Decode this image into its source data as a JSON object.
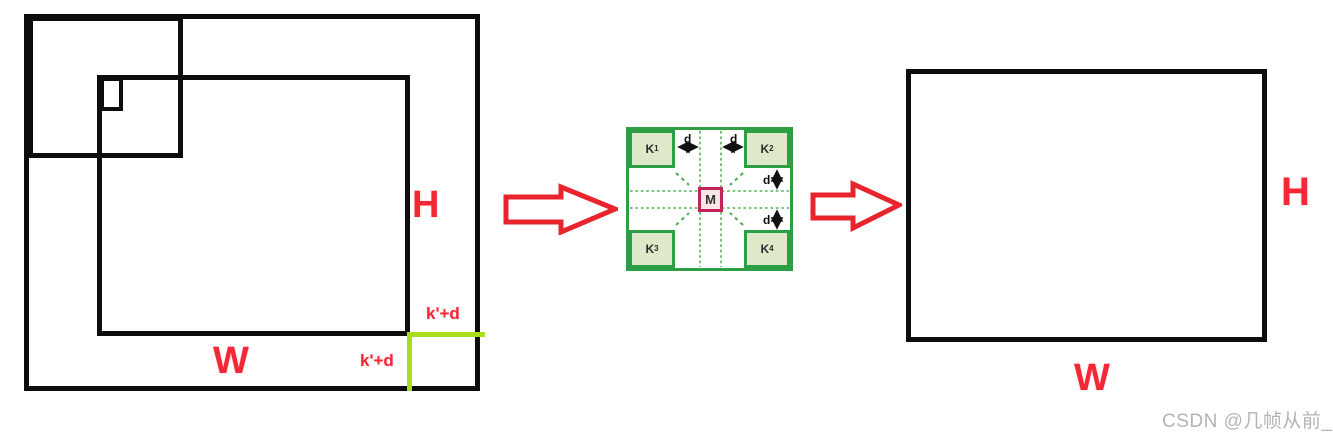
{
  "left_figure": {
    "height_label": "H",
    "width_label": "W",
    "margin_label_right": "k'+d",
    "margin_label_bottom": "k'+d"
  },
  "kernel_diagram": {
    "corners": [
      {
        "base": "K",
        "sub": "1"
      },
      {
        "base": "K",
        "sub": "2"
      },
      {
        "base": "K",
        "sub": "3"
      },
      {
        "base": "K",
        "sub": "4"
      }
    ],
    "center_label": "M",
    "spacing_labels": [
      "d",
      "d",
      "d",
      "d"
    ]
  },
  "right_figure": {
    "height_label": "H",
    "width_label": "W"
  },
  "watermark": "CSDN @几帧从前_",
  "colors": {
    "line_black": "#0d0d0d",
    "label_red": "#f32735",
    "arrow_red": "#e8252c",
    "margin_chartreuse": "#aade1c",
    "kernel_green_border": "#2e9e44",
    "kernel_green_fill": "#dee9ca",
    "dashed_green": "#53b153",
    "center_magenta_border": "#c02458",
    "center_magenta_fill": "#f9e5e3",
    "watermark_gray": "#b4b4b4"
  }
}
